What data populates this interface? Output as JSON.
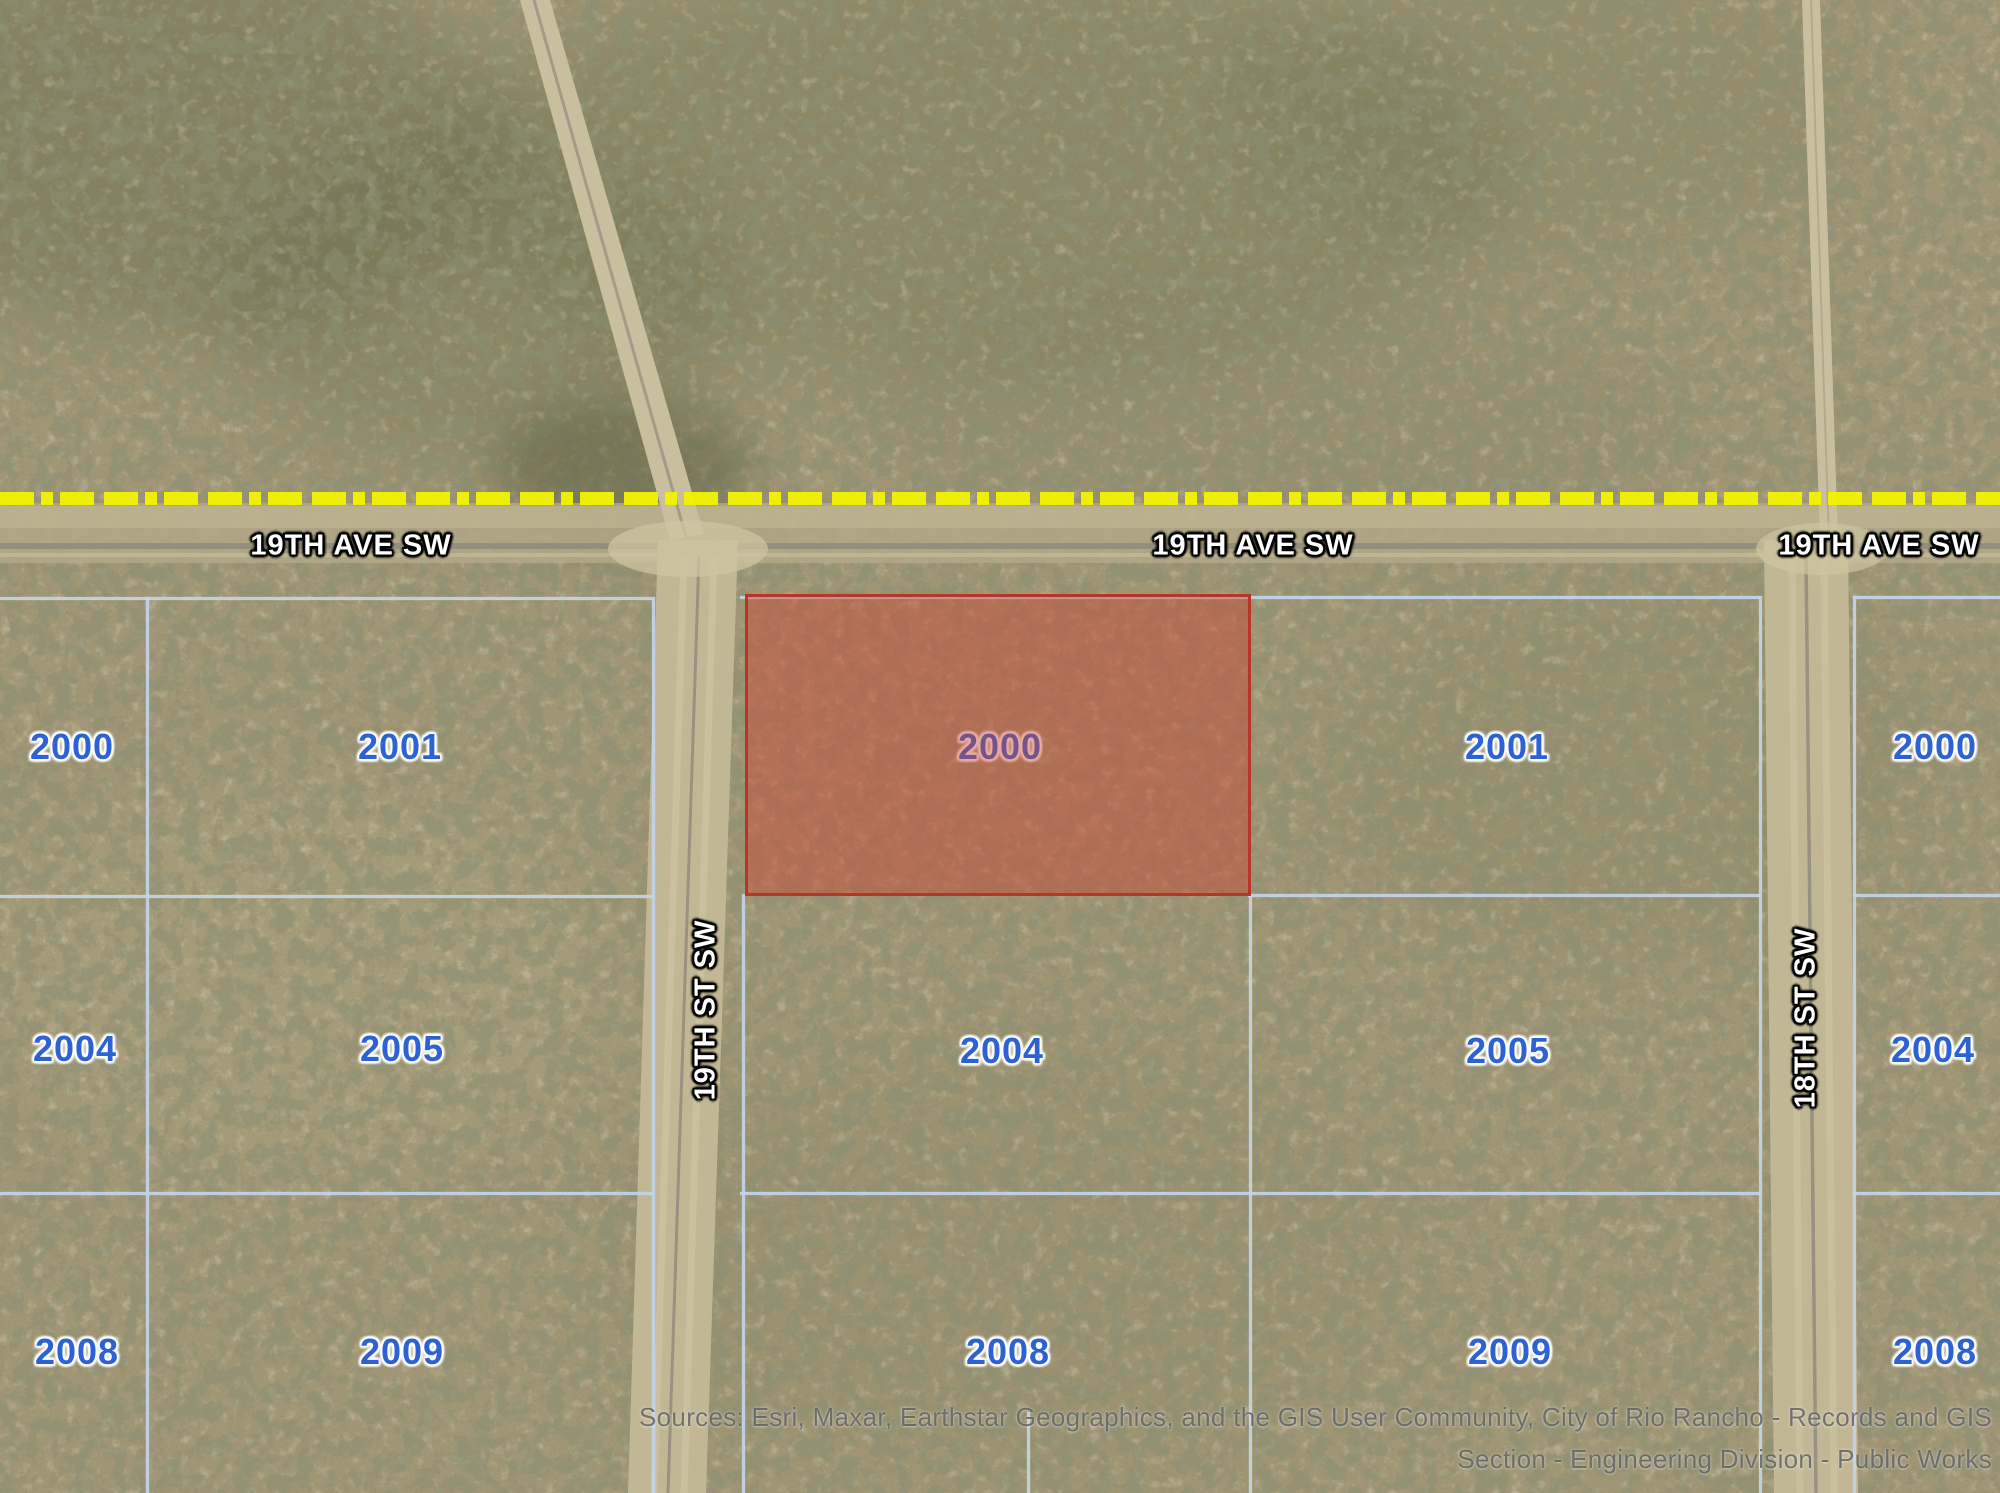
{
  "map": {
    "streets": {
      "avenue": "19TH AVE SW",
      "street_19th": "19TH ST SW",
      "street_18th": "18TH ST SW"
    },
    "highlighted_parcel": {
      "label": "2000",
      "fill_color": "#cc4430",
      "border_color": "#b93527"
    },
    "parcels": [
      {
        "label": "2000"
      },
      {
        "label": "2001"
      },
      {
        "label": "2001"
      },
      {
        "label": "2000"
      },
      {
        "label": "2004"
      },
      {
        "label": "2005"
      },
      {
        "label": "2004"
      },
      {
        "label": "2005"
      },
      {
        "label": "2004"
      },
      {
        "label": "2008"
      },
      {
        "label": "2009"
      },
      {
        "label": "2008"
      },
      {
        "label": "2009"
      },
      {
        "label": "2008"
      }
    ],
    "colors": {
      "parcel_line": "#c3d4e8",
      "parcel_label": "#2d62d4",
      "section_boundary_yellow": "#f1f300",
      "street_label_text": "#ffffff"
    },
    "attribution": {
      "line1": "Sources: Esri, Maxar, Earthstar Geographics, and the GIS User Community, City of Rio Rancho - Records and GIS",
      "line2": "Section - Engineering Division - Public Works"
    }
  }
}
